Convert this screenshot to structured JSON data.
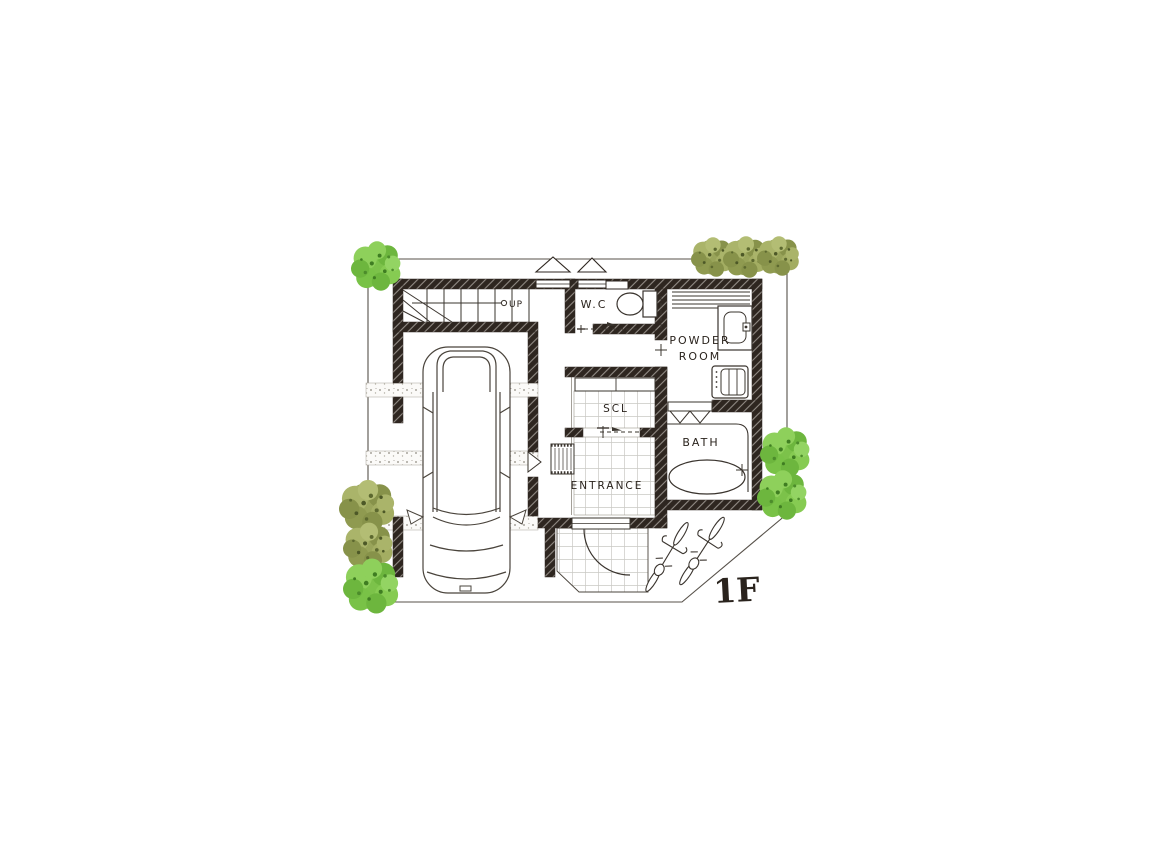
{
  "floor_plan": {
    "floor_label": "1F",
    "rooms": {
      "wc": {
        "label": "W.C"
      },
      "powder_room": {
        "label_line1": "POWDER",
        "label_line2": "ROOM"
      },
      "scl": {
        "label": "SCL"
      },
      "entrance": {
        "label": "ENTRANCE"
      },
      "bath": {
        "label": "BATH"
      }
    },
    "stairs": {
      "direction_label": "UP"
    },
    "objects": [
      "car",
      "stairs",
      "toilet",
      "vanity-sink",
      "washing-machine",
      "bathtub",
      "doormat",
      "front-door",
      "bicycle",
      "bicycle",
      "trees"
    ],
    "colors": {
      "wall": "#2e2620",
      "line": "#3a342e",
      "tile_line": "#c9c8c3",
      "tree_green_bright": "#7cc24a",
      "tree_green_olive": "#99a45a",
      "background": "#ffffff"
    }
  }
}
